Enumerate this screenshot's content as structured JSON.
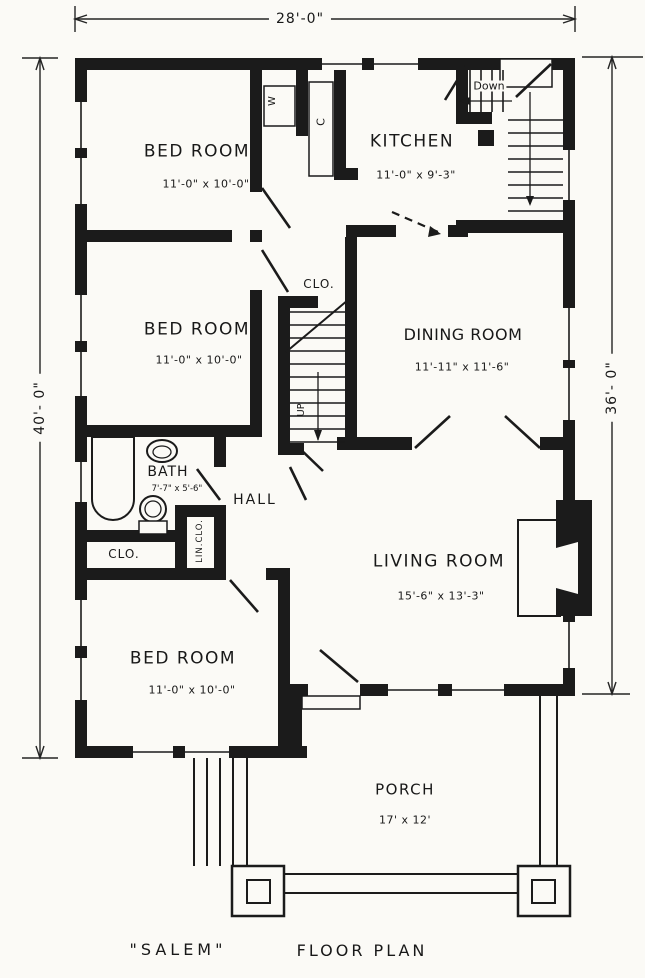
{
  "title": {
    "name": "\"SALEM\"",
    "type": "FLOOR PLAN"
  },
  "dimensions": {
    "width_top": "28'-0\"",
    "height_left": "40'- 0\"",
    "height_right": "36'- 0\""
  },
  "rooms": {
    "bedroom1": {
      "label": "BED ROOM",
      "size": "11'-0\" x 10'-0\""
    },
    "bedroom2": {
      "label": "BED ROOM",
      "size": "11'-0\" x 10'-0\""
    },
    "bedroom3": {
      "label": "BED ROOM",
      "size": "11'-0\" x 10'-0\""
    },
    "kitchen": {
      "label": "KITCHEN",
      "size": "11'-0\" x 9'-3\""
    },
    "dining": {
      "label": "DINING ROOM",
      "size": "11'-11\" x 11'-6\""
    },
    "living": {
      "label": "LIVING ROOM",
      "size": "15'-6\" x 13'-3\""
    },
    "bath": {
      "label": "BATH",
      "size": "7'-7\" x 5'-6\""
    },
    "hall": {
      "label": "HALL"
    },
    "porch": {
      "label": "PORCH",
      "size": "17' x 12'"
    }
  },
  "annotations": {
    "closet_upper": "CLO.",
    "closet_lower": "CLO.",
    "linen_closet": "LIN.CLO.",
    "stair_up": "UP",
    "stair_down": "Down",
    "wardrobe_w": "W",
    "closet_c": "C"
  },
  "colors": {
    "ink": "#1b1b1b",
    "paper": "#fbfaf6"
  }
}
